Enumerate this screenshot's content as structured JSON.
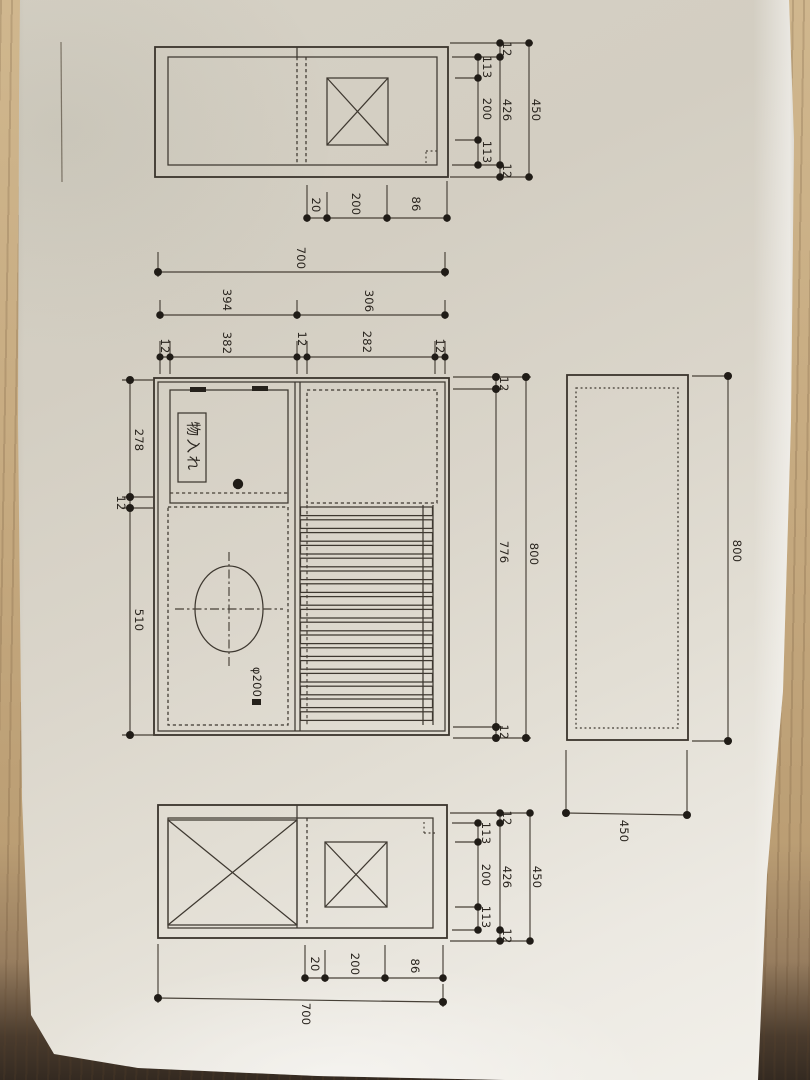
{
  "drawing": {
    "top_cluster": {
      "inner_chain": [
        "113",
        "200",
        "113"
      ],
      "mid_chain": [
        "12",
        "426",
        "12"
      ],
      "total": "450",
      "bottom_chain": [
        "20",
        "200",
        "86"
      ],
      "width_total": "700",
      "width_mid_chain": [
        "394",
        "306"
      ],
      "width_inner_chain": [
        "12",
        "382",
        "12",
        "282",
        "12"
      ]
    },
    "plan": {
      "storage_label": "物入れ",
      "hole_label": "φ200",
      "left_chain": [
        "278",
        "12",
        "510"
      ],
      "right_inner_chain": [
        "12",
        "776",
        "12"
      ],
      "right_total": "800"
    },
    "side": {
      "height_total": "800",
      "width_total": "450"
    },
    "bottom_cluster": {
      "inner_chain": [
        "113",
        "200",
        "113"
      ],
      "mid_chain": [
        "12",
        "426",
        "12"
      ],
      "total": "450",
      "bottom_chain": [
        "20",
        "200",
        "86"
      ],
      "width_total": "700"
    }
  }
}
